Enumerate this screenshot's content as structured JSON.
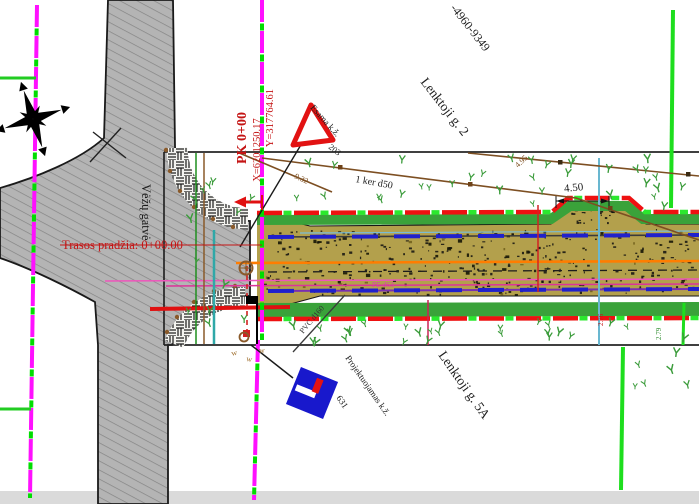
{
  "drawing": {
    "streets": {
      "vertical": "Vėžų gatvė",
      "northeast": "Lenktoji g. 2",
      "southeast": "Lenktoji g. 5A"
    },
    "parcel_number": "-4960-9349",
    "station": {
      "pk": "PK 0+00",
      "x": "X=6201250.17",
      "y": "Y=317764.61"
    },
    "route_start": "Trasos pradžia: 0+00.00",
    "signs": {
      "existing": {
        "label": "Esama k.ž.",
        "number": "203"
      },
      "proposed": {
        "label": "Projektuojamas k.ž.",
        "number": "631"
      }
    },
    "utilities": {
      "cable": "1 ker d50",
      "pvc": "PVC d160",
      "pe": "PE d63"
    },
    "dimensions": {
      "width": "4.50",
      "a": "4.95",
      "b": "9.32",
      "c": "2.76",
      "d": "2.79"
    },
    "colors": {
      "cadastral_magenta": "#ff10ff",
      "survey_green": "#00dd00",
      "bright_green_line": "#1ede1e",
      "design_red": "#ee1111",
      "design_green_dash": "#2be82e",
      "gravel_olive": "#b3a04c",
      "verge_green": "#3aa23a",
      "asphalt_gray": "#b4b4b4",
      "axis_orange": "#ff7d00",
      "drainage_blue": "#2020cc",
      "existing_sign_red": "#e21212",
      "proposed_sign_blue": "#1818cc",
      "utility_brown": "#8a5a2a",
      "water_teal": "#2fa8a8"
    }
  }
}
